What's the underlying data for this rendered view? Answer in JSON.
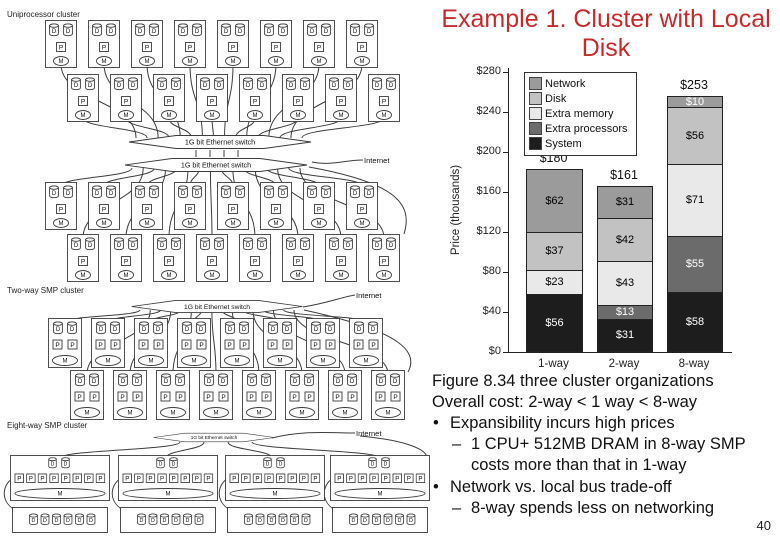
{
  "slide": {
    "title": "Example 1. Cluster with Local Disk"
  },
  "page_number": "40",
  "diagram": {
    "sections": [
      {
        "label": "Uniprocessor cluster"
      },
      {
        "label": "Two-way SMP cluster"
      },
      {
        "label": "Eight-way SMP cluster"
      }
    ],
    "switch_label": "1G bit Ethernet switch",
    "internet_label": "Internet",
    "processor_letter": "P",
    "memory_letter": "M",
    "disk_letter": "D"
  },
  "chart_data": {
    "type": "bar",
    "subtype": "stacked",
    "title": "",
    "ylabel": "Price (thousands)",
    "categories": [
      "1-way",
      "2-way",
      "8-way"
    ],
    "totals": [
      "$180",
      "$161",
      "$253"
    ],
    "y_ticks": [
      "$0",
      "$40",
      "$80",
      "$120",
      "$160",
      "$200",
      "$240",
      "$280"
    ],
    "ylim": [
      0,
      280
    ],
    "grid": false,
    "legend_position": "top-left",
    "series": [
      {
        "name": "Network",
        "color": "#9b9b9b",
        "values": [
          62,
          31,
          10
        ],
        "label_colors": [
          "#000",
          "#000",
          "#fff"
        ]
      },
      {
        "name": "Disk",
        "color": "#c2c2c2",
        "values": [
          37,
          42,
          56
        ],
        "label_colors": [
          "#000",
          "#000",
          "#000"
        ]
      },
      {
        "name": "Extra memory",
        "color": "#e9e9e9",
        "values": [
          23,
          43,
          71
        ],
        "label_colors": [
          "#000",
          "#000",
          "#000"
        ]
      },
      {
        "name": "Extra processors",
        "color": "#6b6b6b",
        "values": [
          0,
          13,
          55
        ],
        "label_colors": [
          "#fff",
          "#fff",
          "#fff"
        ]
      },
      {
        "name": "System",
        "color": "#1d1d1d",
        "values": [
          56,
          31,
          58
        ],
        "label_colors": [
          "#fff",
          "#fff",
          "#fff"
        ]
      }
    ]
  },
  "notes": {
    "line1": "Figure 8.34 three cluster organizations",
    "line2": "Overall cost: 2-way < 1 way < 8-way",
    "bullets": [
      {
        "marker": "•",
        "text": "Expansibility incurs high prices",
        "sub": [
          {
            "marker": "–",
            "text": "1 CPU+ 512MB DRAM in 8-way SMP costs more than that in 1-way"
          }
        ]
      },
      {
        "marker": "•",
        "text": "Network vs. local bus trade-off",
        "sub": [
          {
            "marker": "–",
            "text": "8-way spends less on networking"
          }
        ]
      }
    ]
  }
}
